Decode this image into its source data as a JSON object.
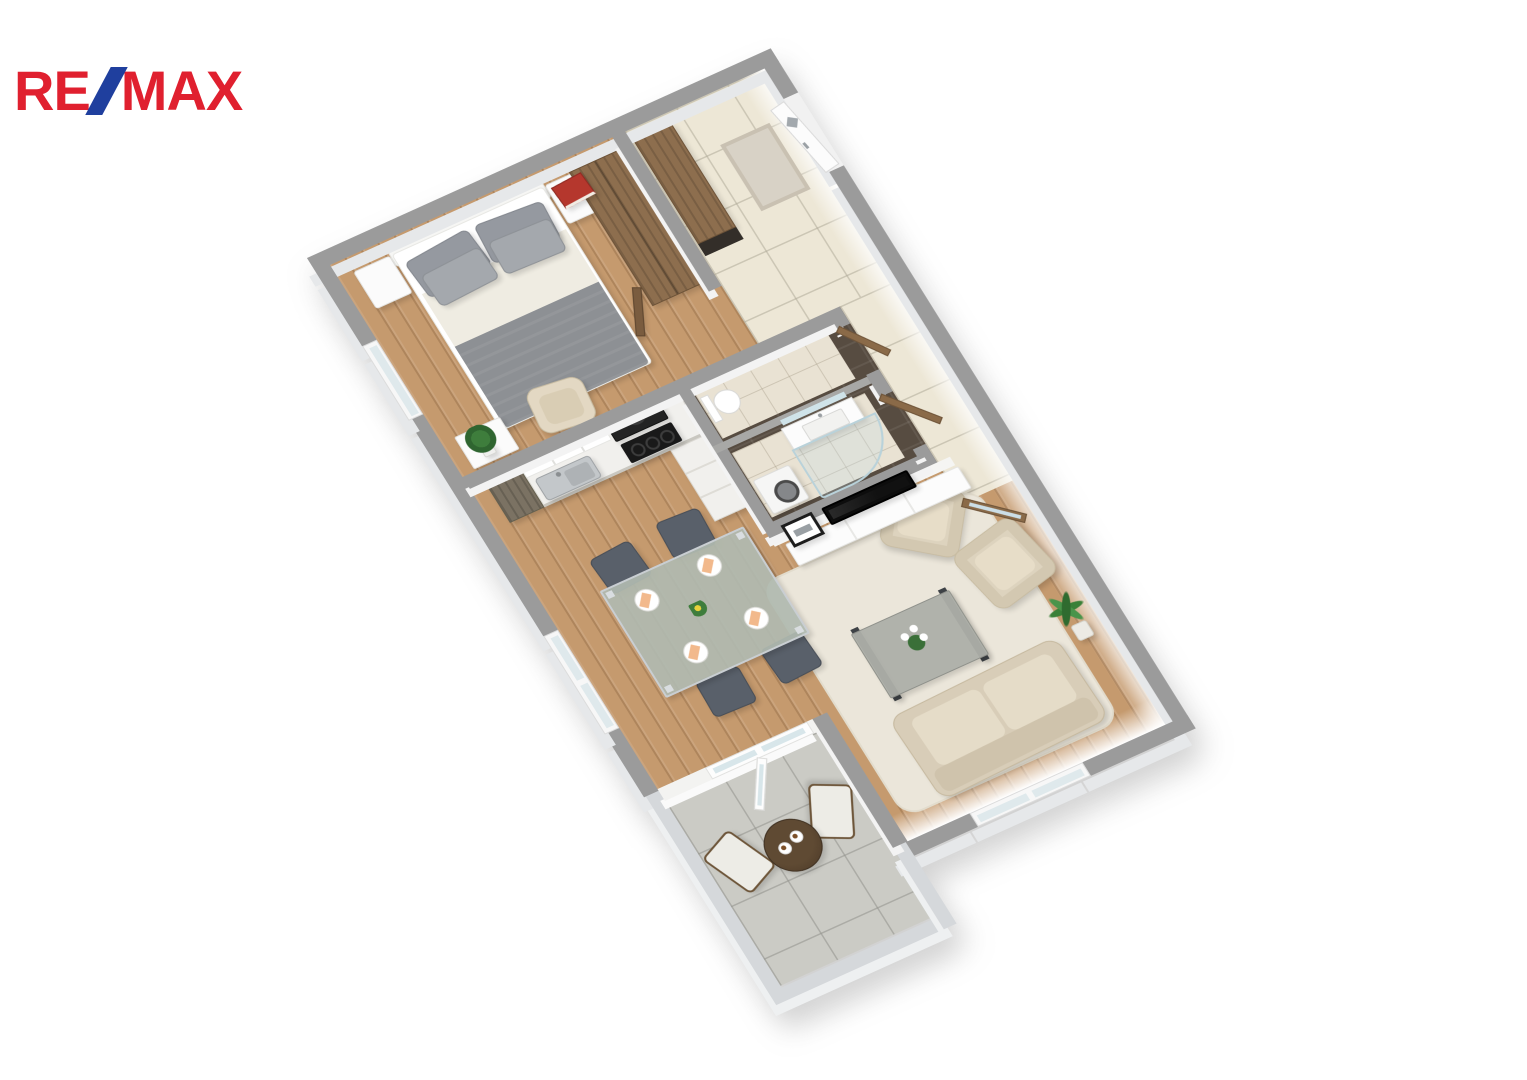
{
  "logo": {
    "re": "RE",
    "slash": "/",
    "max": "MAX",
    "color_red": "#E0202F",
    "color_blue": "#1F3F9E"
  },
  "scene": {
    "type": "3D floor plan render, top-down view, rotated diagonally",
    "background": "#FFFFFF",
    "wall_top_color": "#9B9B9B",
    "wall_face_color": "#F2F2F2",
    "balcony_wall_color": "#D5D8DB",
    "wood_floor_color": "#C59A6E",
    "hallway_tile_color": "#EDE7D6",
    "balcony_tile_color": "#CBCBC5",
    "bathroom_dark_tile_color": "#574C41",
    "door_wood_color": "#8A6A48",
    "rooms": [
      {
        "name": "bedroom",
        "floor": "wood",
        "furniture": [
          "double-bed",
          "four-gray-pillows",
          "gray-blanket",
          "nightstand-left",
          "nightstand-right",
          "red-book",
          "wardrobe",
          "beige-armchair",
          "white-bench",
          "potted-plant",
          "window"
        ]
      },
      {
        "name": "entrance-hall",
        "floor": "beige-tile",
        "furniture": [
          "entry-door-with-diamond-window",
          "doormat",
          "hall-cabinet"
        ]
      },
      {
        "name": "wc",
        "floor": "light-tile",
        "furniture": [
          "toilet",
          "wc-door"
        ]
      },
      {
        "name": "bathroom",
        "floor": "light-tile",
        "furniture": [
          "vanity-sink",
          "mirror",
          "washing-machine",
          "curved-glass-shower",
          "bathroom-door"
        ]
      },
      {
        "name": "kitchen",
        "floor": "wood",
        "furniture": [
          "l-shaped-counter",
          "steel-sink",
          "black-cooktop",
          "black-range-hood",
          "white-upper-cabinets",
          "tall-cabinet"
        ]
      },
      {
        "name": "dining-area",
        "floor": "wood",
        "furniture": [
          "glass-dining-table",
          "four-dark-chairs",
          "four-place-settings",
          "peach-napkins",
          "flower-centerpiece"
        ]
      },
      {
        "name": "living-room",
        "floor": "wood",
        "furniture": [
          "tv-wall",
          "flat-tv",
          "picture-frame",
          "white-sideboard",
          "cream-rug",
          "coffee-table",
          "white-orchid",
          "beige-armchair-1",
          "beige-armchair-2",
          "beige-sofa",
          "palm-plant",
          "wood-glass-door",
          "window"
        ]
      },
      {
        "name": "balcony",
        "floor": "gray-tile",
        "furniture": [
          "round-wood-table",
          "two-coffee-cups",
          "folding-chair-1",
          "folding-chair-2",
          "french-door"
        ]
      }
    ]
  }
}
